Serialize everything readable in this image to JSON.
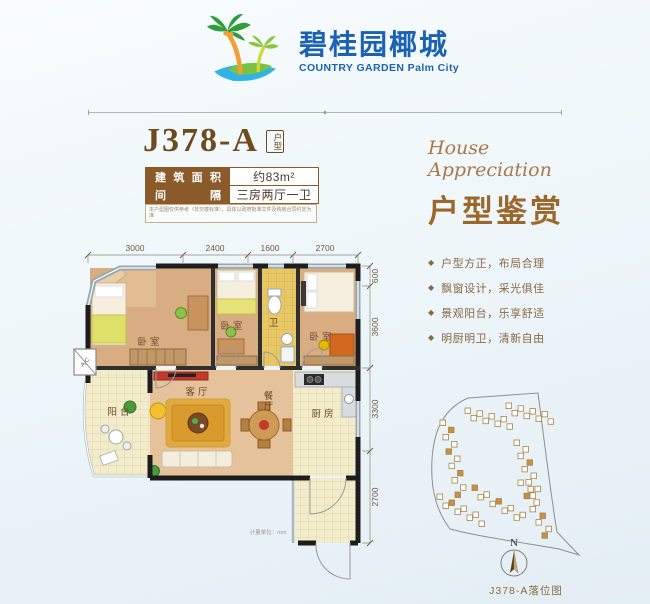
{
  "brand": {
    "logo_icon": "palm-tree-icon",
    "name_cn": "碧桂园椰城",
    "name_en": "COUNTRY GARDEN Palm City"
  },
  "unit": {
    "code": "J378-A",
    "badge": "户型",
    "specs": [
      {
        "label": "建筑面积",
        "value": "约83m²"
      },
      {
        "label": "间隔",
        "value": "三房两厅一卫"
      }
    ],
    "disclaimer": "本户型图仅供参考（非交楼标准），具体以政府批准文件及购房合同约定为准"
  },
  "appreciation": {
    "title_en": "House Appreciation",
    "title_cn": "户型鉴赏",
    "bullet_icon": "◆",
    "bullets": [
      "户型方正，布局合理",
      "飘窗设计，采光俱佳",
      "景观阳台，乐享舒适",
      "明厨明卫，清新自由"
    ]
  },
  "floorplan": {
    "rooms": {
      "bedroom1": "卧室",
      "bedroom2": "卧室",
      "bedroom3": "卧室",
      "bath": "卫",
      "living": "客厅",
      "dining": "餐厅",
      "kitchen": "厨房",
      "balcony": "阳台"
    },
    "dims_top": [
      "3000",
      "2400",
      "1600",
      "2700"
    ],
    "dims_right": [
      "600",
      "3600",
      "3300",
      "2700"
    ],
    "ac_label": "A/C",
    "unit_note": "计量单位：mm"
  },
  "siteplan": {
    "north_label": "N",
    "caption": "J378-A落位图"
  },
  "colors": {
    "brand_blue": "#1b62b4",
    "title_brown": "#6f4a1f",
    "accent_brown": "#8a5a28",
    "bullet_brown": "#8a6a45",
    "building_fill": "#c79045"
  }
}
